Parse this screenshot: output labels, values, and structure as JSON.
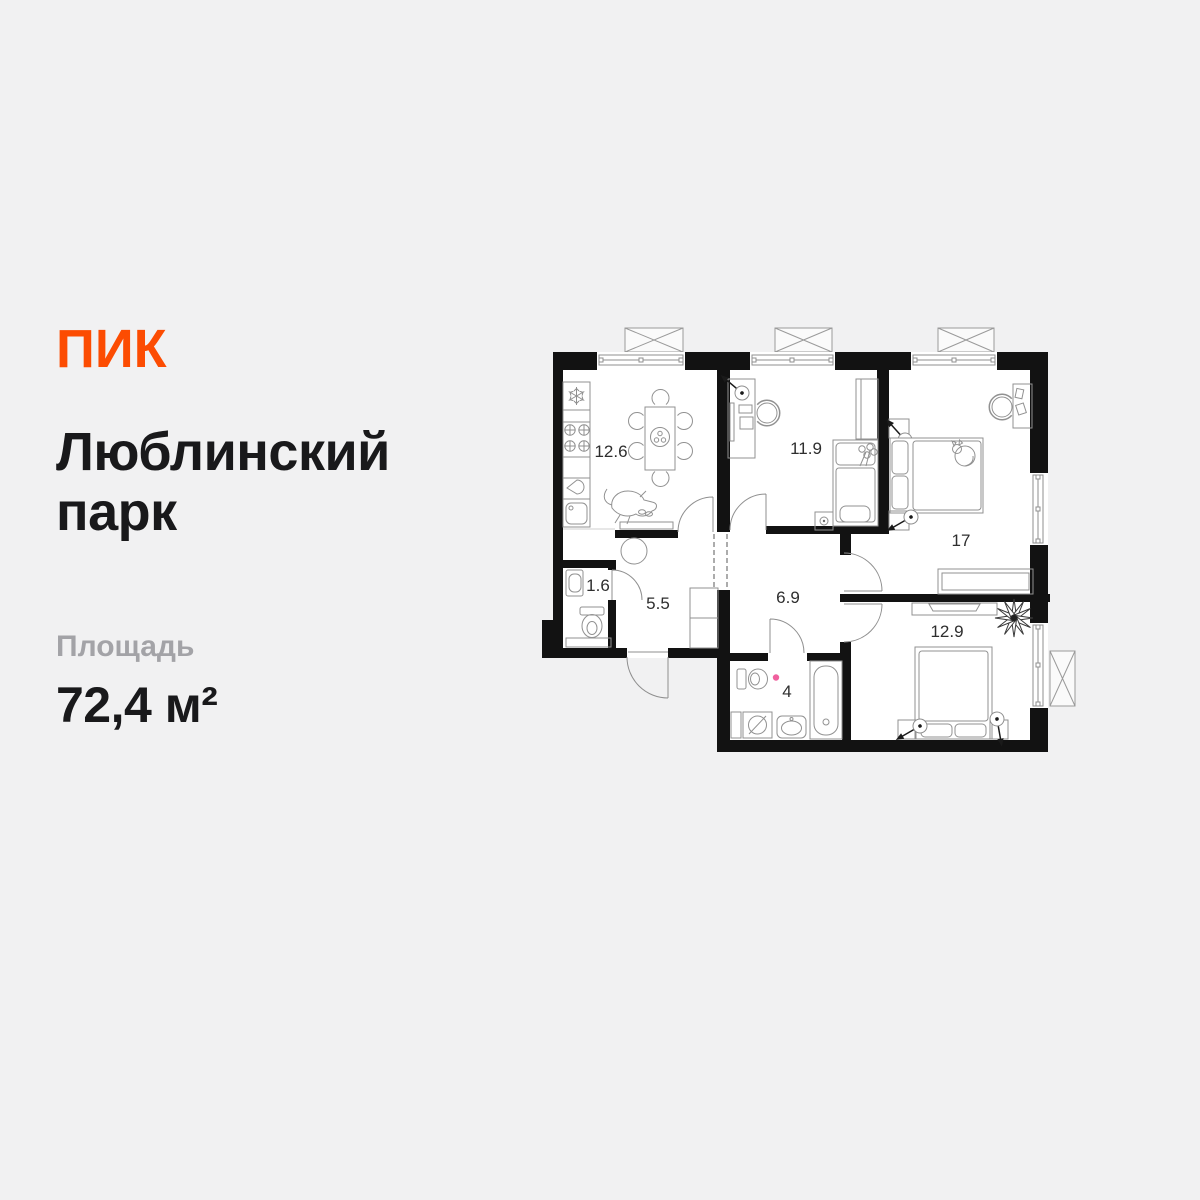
{
  "page": {
    "background": "#f1f1f2"
  },
  "brand": {
    "logo_text": "ПИК",
    "logo_color": "#fc4c02"
  },
  "listing": {
    "title_line1": "Люблинский",
    "title_line2": "парк",
    "area_label": "Площадь",
    "area_value": "72,4 м²"
  },
  "plan": {
    "colors": {
      "wall": "#121212",
      "floor": "#ffffff",
      "furniture_stroke": "#919191",
      "room_label": "#2e2e2e",
      "accent_dot": "#f0609e"
    },
    "rooms": [
      {
        "name": "kitchen",
        "area": "12.6"
      },
      {
        "name": "bedroom-1",
        "area": "11.9"
      },
      {
        "name": "bedroom-2",
        "area": "17"
      },
      {
        "name": "wc",
        "area": "1.6"
      },
      {
        "name": "hallway",
        "area": "5.5"
      },
      {
        "name": "corridor",
        "area": "6.9"
      },
      {
        "name": "bathroom",
        "area": "4"
      },
      {
        "name": "bedroom-3",
        "area": "12.9"
      }
    ]
  }
}
